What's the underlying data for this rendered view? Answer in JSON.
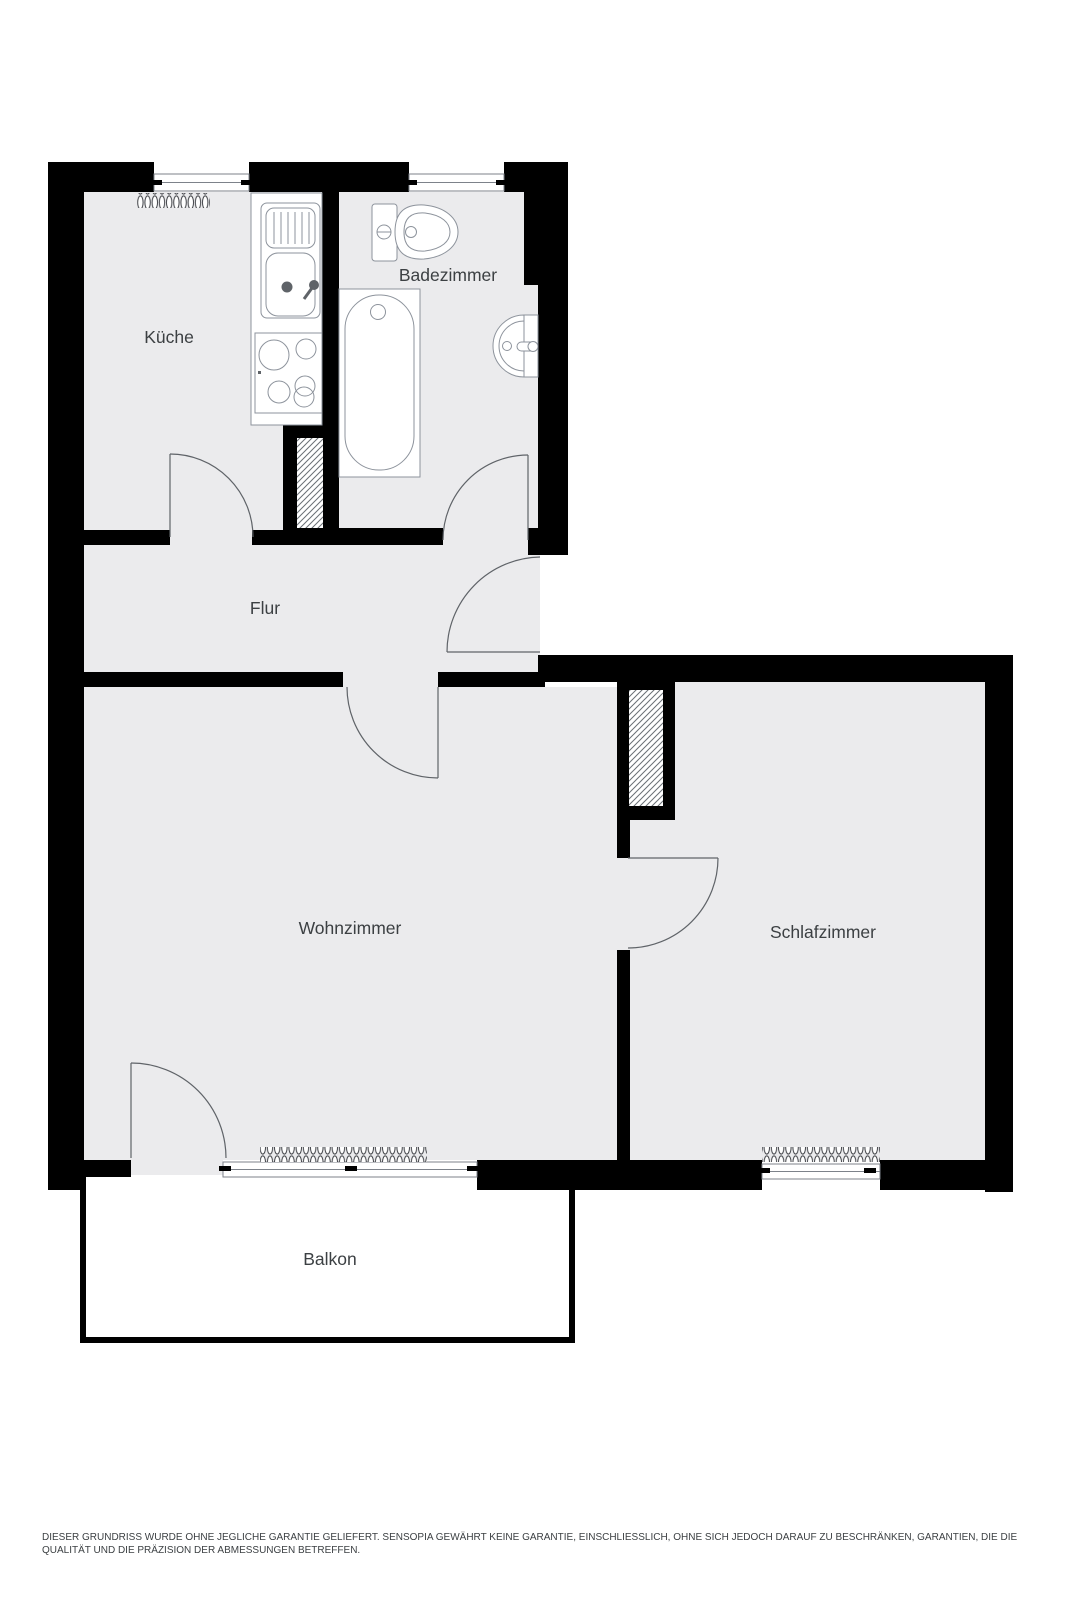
{
  "plan": {
    "type": "floorplan",
    "rooms": {
      "kueche": {
        "label": "Küche"
      },
      "badezimmer": {
        "label": "Badezimmer"
      },
      "flur": {
        "label": "Flur"
      },
      "wohnzimmer": {
        "label": "Wohnzimmer"
      },
      "schlafzimmer": {
        "label": "Schlafzimmer"
      },
      "balkon": {
        "label": "Balkon"
      }
    },
    "fixtures": [
      "kitchen-sink-icon",
      "kitchen-stove-icon",
      "toilet-icon",
      "bathtub-icon",
      "wash-basin-icon",
      "radiator-icon",
      "window-icon",
      "door-swing-icon"
    ],
    "colors": {
      "wall": "#000000",
      "floor": "#ebebed",
      "fixture_stroke": "#8d939c",
      "door_stroke": "#5f6368",
      "label": "#3c4043",
      "balcony_fill": "#ffffff"
    }
  },
  "disclaimer": {
    "line1": "DIESER GRUNDRISS WURDE OHNE JEGLICHE GARANTIE GELIEFERT. SENSOPIA GEWÄHRT KEINE GARANTIE, EINSCHLIESSLICH, OHNE SICH JEDOCH DARAUF ZU BESCHRÄNKEN, GARANTIEN, DIE DIE",
    "line2": "QUALITÄT UND DIE PRÄZISION DER ABMESSUNGEN BETREFFEN."
  }
}
